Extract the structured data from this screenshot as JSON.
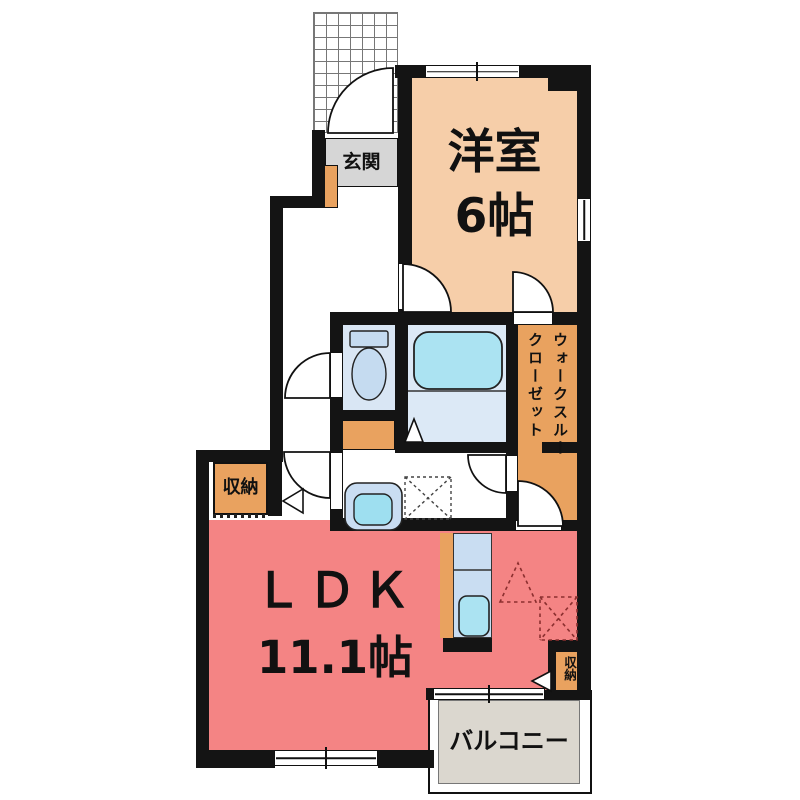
{
  "title": "apartment-floor-plan",
  "labels": {
    "entrance": "玄関",
    "western_room": "洋室",
    "western_room_size": "6帖",
    "walk_through_closet_line1": "ウォークスルー",
    "walk_through_closet_line2": "クローゼット",
    "storage_left": "収納",
    "storage_right": "収納",
    "ldk": "ＬＤＫ",
    "ldk_size": "11.1帖",
    "balcony": "バルコニー"
  },
  "colors": {
    "wall": "#141414",
    "western_room_floor": "#F6CEA9",
    "ldk_floor": "#F48484",
    "closet_storage_fill": "#E9A25F",
    "balcony_fill": "#DBD7CF",
    "entrance_floor": "#D6D6D6",
    "wet_floor": "#DCE9F6",
    "toilet_floor": "#D9E6F4",
    "fixture_blue": "#C5DBF0",
    "water_cyan": "#ABE3F2"
  }
}
